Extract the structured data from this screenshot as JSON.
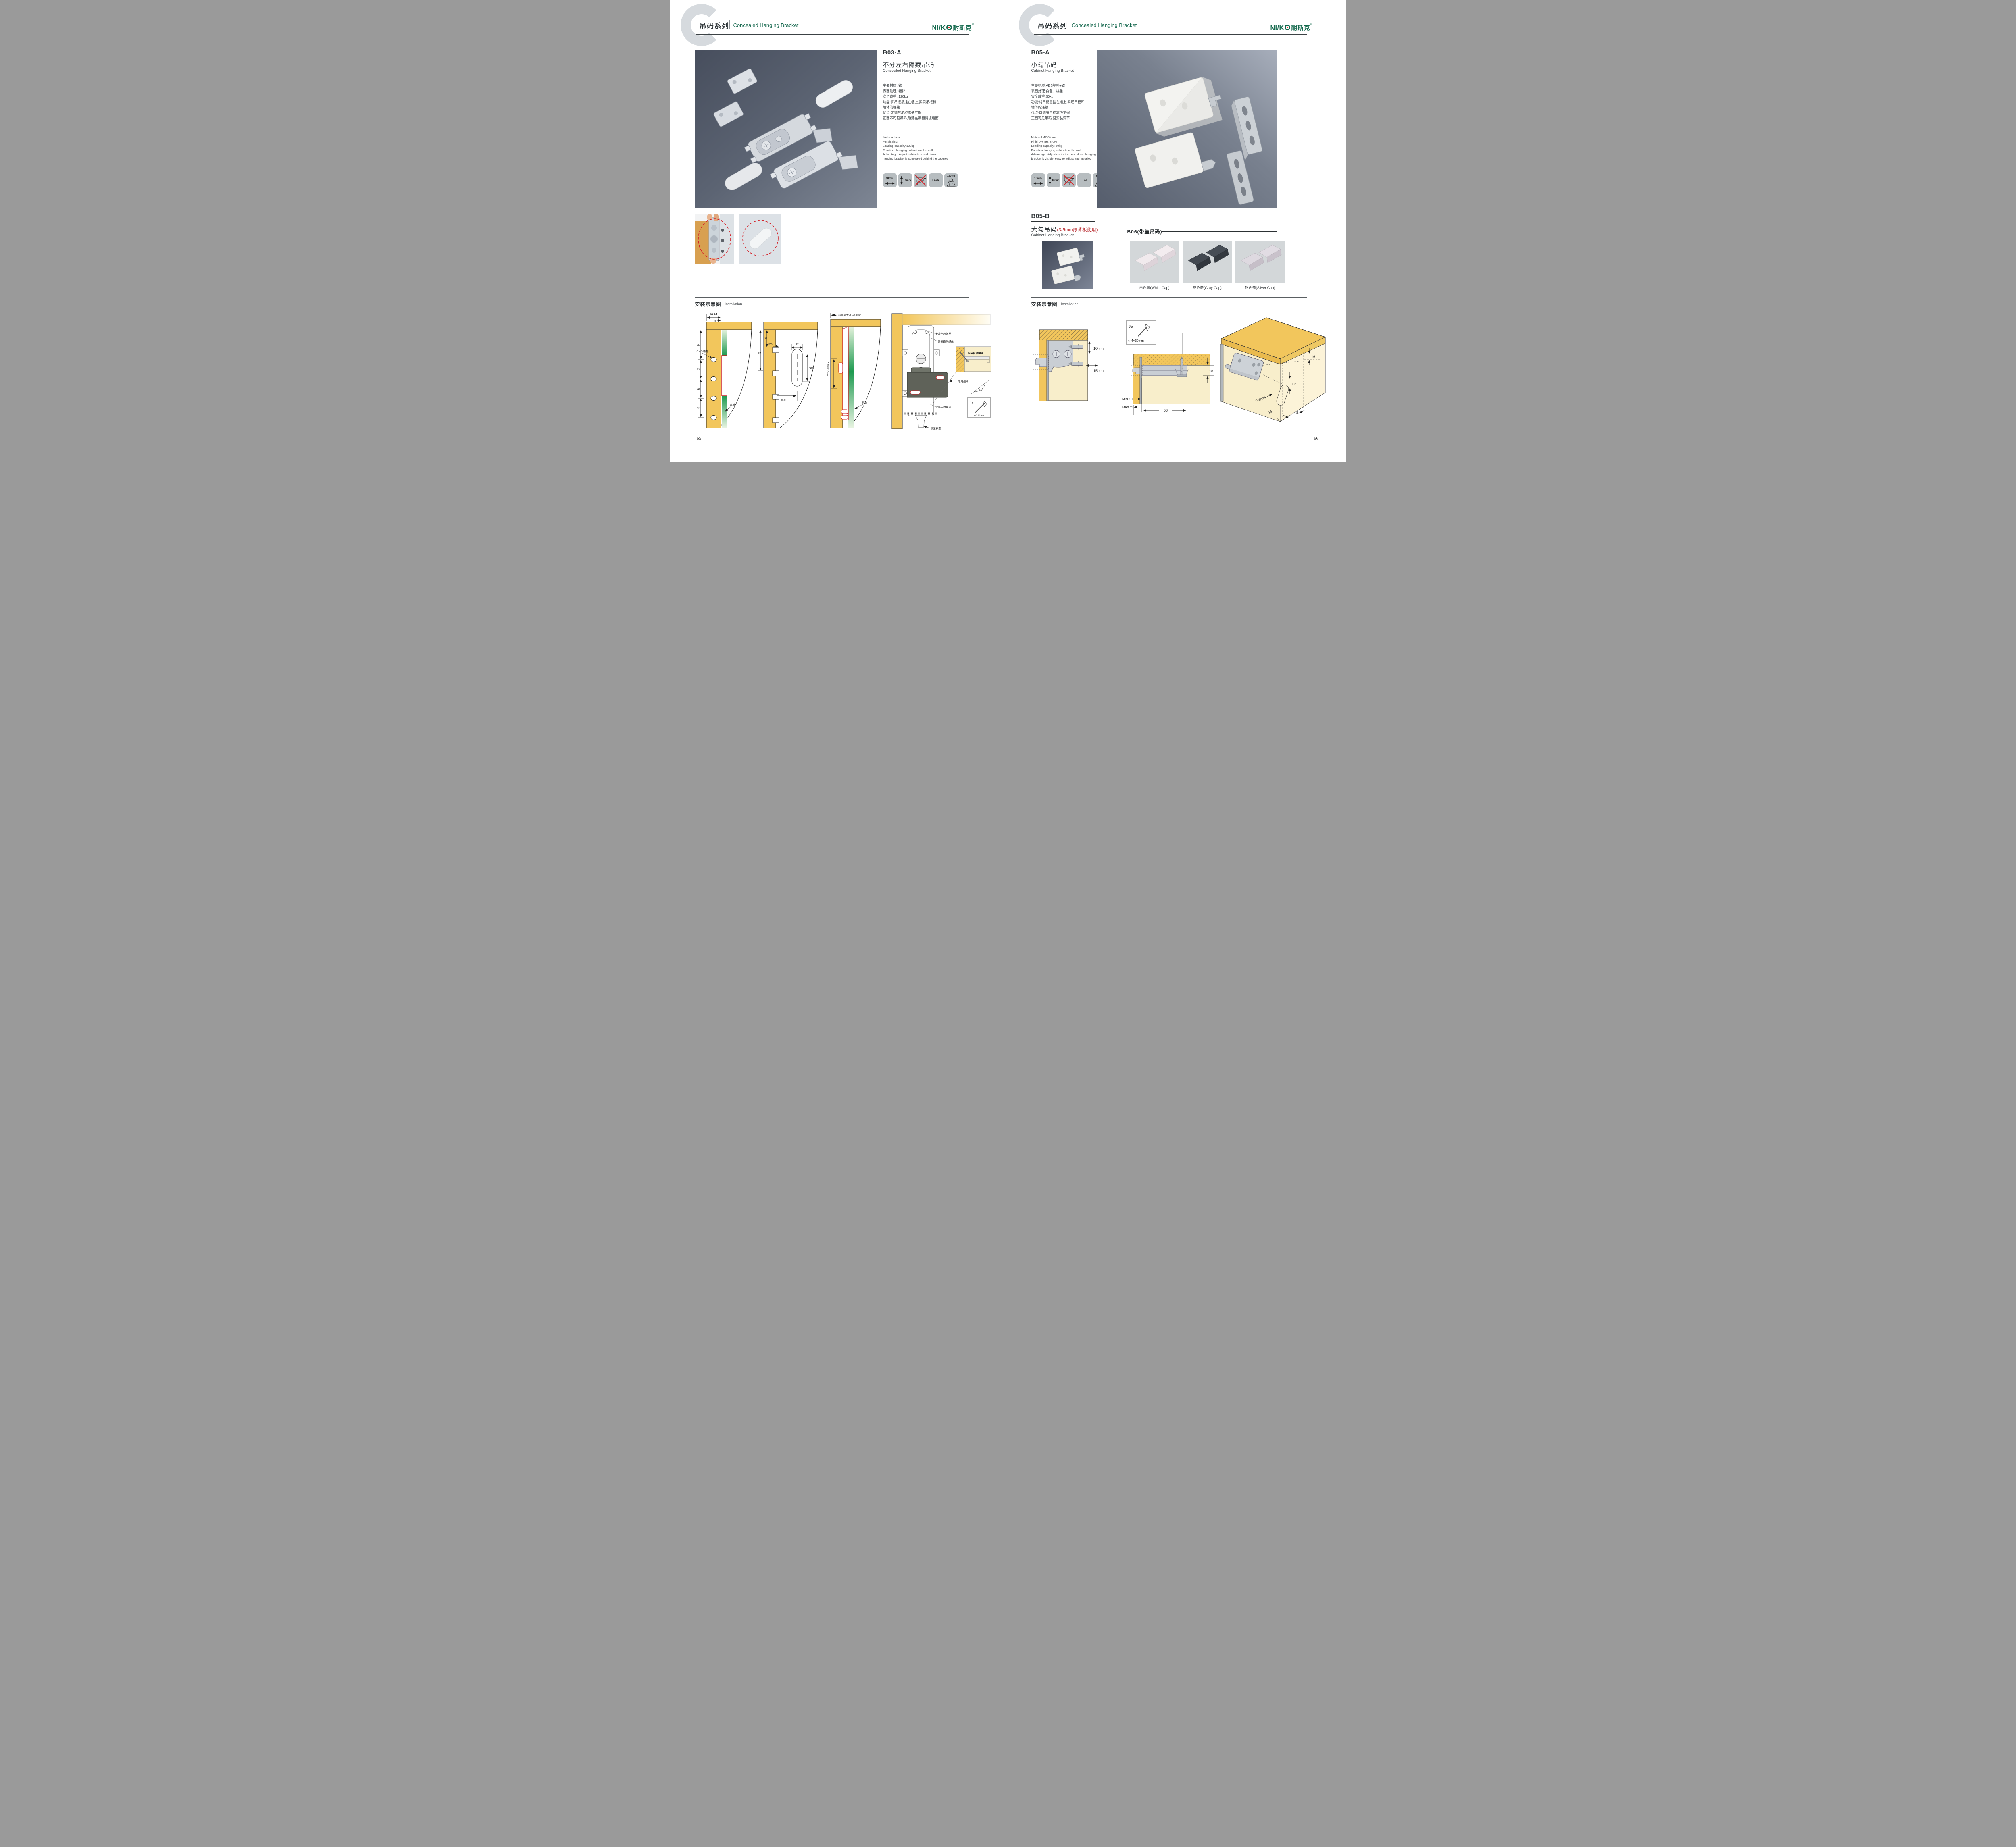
{
  "brand": {
    "logo_ni": "NI",
    "logo_s": "/",
    "logo_k": "K",
    "logo_cn": "耐斯克",
    "logo_reg": "®"
  },
  "header": {
    "series_cn": "吊码系列",
    "series_en": "Concealed Hanging Bracket",
    "watermark_letter": "C"
  },
  "install_title": {
    "cn": "安装示意图",
    "en": "Installation"
  },
  "left_page": {
    "page_number": "65",
    "product": {
      "code": "B03-A",
      "name_cn": "不分左右隐藏吊码",
      "name_en": "Concealed Hanging Bracket",
      "specs_cn": [
        "主要材质: 铁",
        "表面处理: 镀锌",
        "安全载重: 120kg",
        "功能:将吊柜悬挂在墙上,实现吊柜和",
        "墙体的连接",
        "优点:可调节吊柜高低平衡",
        "正面不可见吊码,隐藏在吊柜背板后面"
      ],
      "specs_en": [
        "Material:Iron",
        "Finish:Zinc",
        "Loading capacity:120kg",
        "Function: hanging cabinet on the wall",
        "Advantage: Adjust cabinet up and down",
        "hanging bracket is concealed behind the cabinet"
      ],
      "icons": {
        "width": "10mm",
        "height": "10mm",
        "lga": "LGA",
        "load": "120Kg"
      }
    },
    "diagram1": {
      "dim_top": "16-18",
      "dim_5": "5",
      "dim_35": "35",
      "dim_32a": "32",
      "dim_32b": "32",
      "dim_32c": "32",
      "label_holes": "10-4个均布",
      "label_back": "背板"
    },
    "diagram2": {
      "dim_35": "35",
      "dim_60": "60",
      "dim_125": "12.5",
      "dim_12": "12",
      "dim_425": "42.5",
      "dim_205": "20.5"
    },
    "diagram3": {
      "label_top": "前后最大调节10mm",
      "label_left": "上下调节10mm",
      "label_back": "背板"
    },
    "diagram4": {
      "screw1": "安装自攻螺丝",
      "screw2": "安装自攻螺丝",
      "screw3": "安装自攻螺丝",
      "plate": "专用挂片",
      "lock": "锁紧状态",
      "detail_screw": "安装自攻螺丝",
      "angle": "45°",
      "qty": "1x",
      "dia": "Φ3.5mm"
    }
  },
  "right_page": {
    "page_number": "66",
    "product_a": {
      "code": "B05-A",
      "name_cn": "小勾吊码",
      "name_en": "Cabinet Hanging Bracket",
      "specs_cn": [
        "主要材质:ABS塑料+铁",
        "表面处理:白色、棕色",
        "安全载重:60kg",
        "功能:将吊柜悬挂在墙上,实现吊柜和",
        "墙体的连接",
        "优点:可调节吊柜高低平衡",
        "正面可见吊码,易安装调节"
      ],
      "specs_en": [
        "Material: ABS+Iron",
        "Finish:White, Brown",
        "Loading capacity: 60kg",
        "Function: hanging cabinet on the wall",
        "Advantage: Adjust cabinet up and down hanging",
        "bracket is visible, easy to adjust and installed"
      ],
      "icons": {
        "width": "15mm",
        "height": "10mm",
        "lga": "LGA",
        "load": "60Kg"
      }
    },
    "product_b": {
      "code": "B05-B",
      "name_cn": "大勾吊码",
      "note": "(3-9mm厚背板使用)",
      "name_en": "Cabinet Hanging Brcaket"
    },
    "product_c": {
      "code": "B06(带盖吊码)",
      "caps": [
        "白色盖(White Cap)",
        "灰色盖(Gray Cap)",
        "银色盖(Silver Cap)"
      ]
    },
    "diagram1": {
      "adj_v": "10mm",
      "adj_h": "15mm"
    },
    "diagram2": {
      "qty": "2x",
      "size": "Φ 4×30mm",
      "d18": "18",
      "dmin": "MIN.10",
      "dmax": "MAX.23",
      "d58": "58"
    },
    "diagram3": {
      "d16a": "16",
      "d42": "42",
      "rmax": "RMAX4",
      "d16b": "16",
      "d17": "17",
      "d32": "32"
    }
  }
}
